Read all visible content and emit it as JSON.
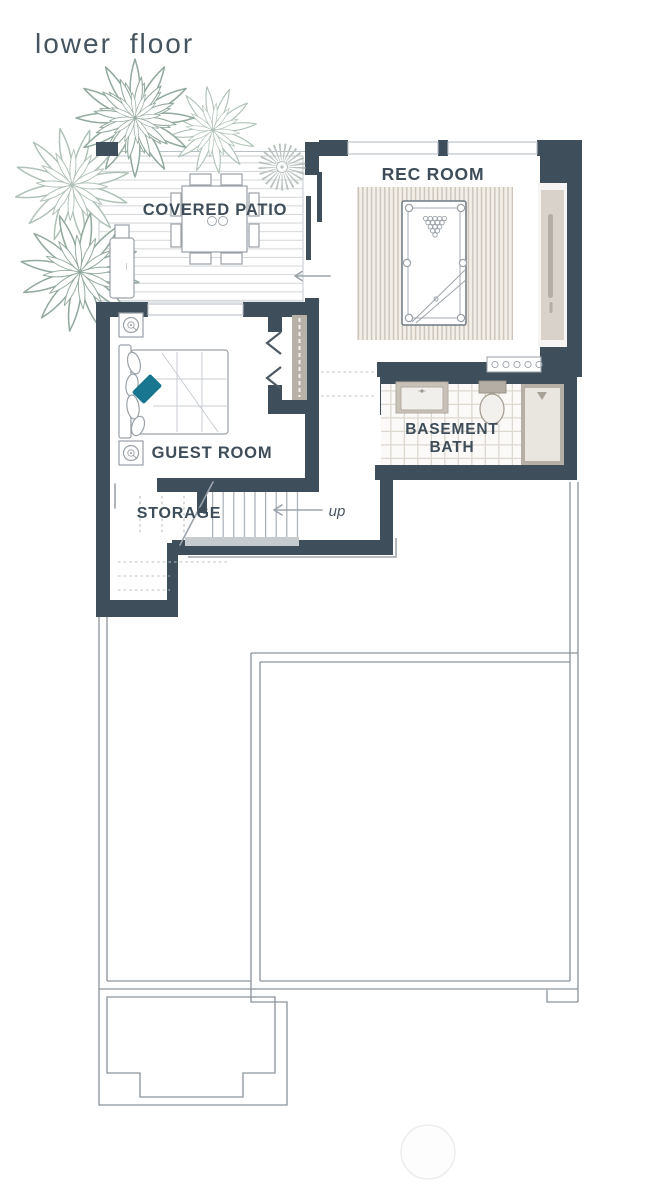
{
  "title": "lower floor",
  "rooms": {
    "covered_patio": {
      "label": "COVERED PATIO"
    },
    "rec_room": {
      "label": "REC ROOM"
    },
    "guest_room": {
      "label": "GUEST ROOM"
    },
    "basement_bath": {
      "line1": "BASEMENT",
      "line2": "BATH"
    },
    "storage": {
      "label": "STORAGE"
    }
  },
  "stairs": {
    "direction_label": "up"
  },
  "icons": [
    "agave-plant-icon",
    "sunburst-plant-icon",
    "dining-table",
    "dining-chair",
    "grill",
    "pool-table",
    "billiard-rack",
    "cue-stick",
    "bed",
    "pillow",
    "accent-pillow",
    "nightstand",
    "table-lamp-icon",
    "bifold-door",
    "sliding-door",
    "closet-rod",
    "vanity-sink",
    "toilet",
    "shower",
    "stair-treads",
    "wine-rack",
    "entry-arrow",
    "up-arrow"
  ],
  "colors": {
    "wall": "#3f4e5b",
    "label": "#3e4d59",
    "title": "#46545f",
    "accent_teal": "#197691",
    "plant_sage": "#93aa9e",
    "plant_sage_light": "#b0c2b7",
    "beige": "#d8d2ca",
    "beige_dark": "#b8b1a7",
    "line": "#8a939b",
    "light_line": "#b9c0c6",
    "arrow": "#9aa3ab",
    "furniture_stroke": "#9aa1a8",
    "deck_line": "#d6d9db",
    "rug_stripe": "#ccc4b9",
    "tile_line": "#ddd8d0",
    "gray_bar": "#c6cbcf"
  }
}
